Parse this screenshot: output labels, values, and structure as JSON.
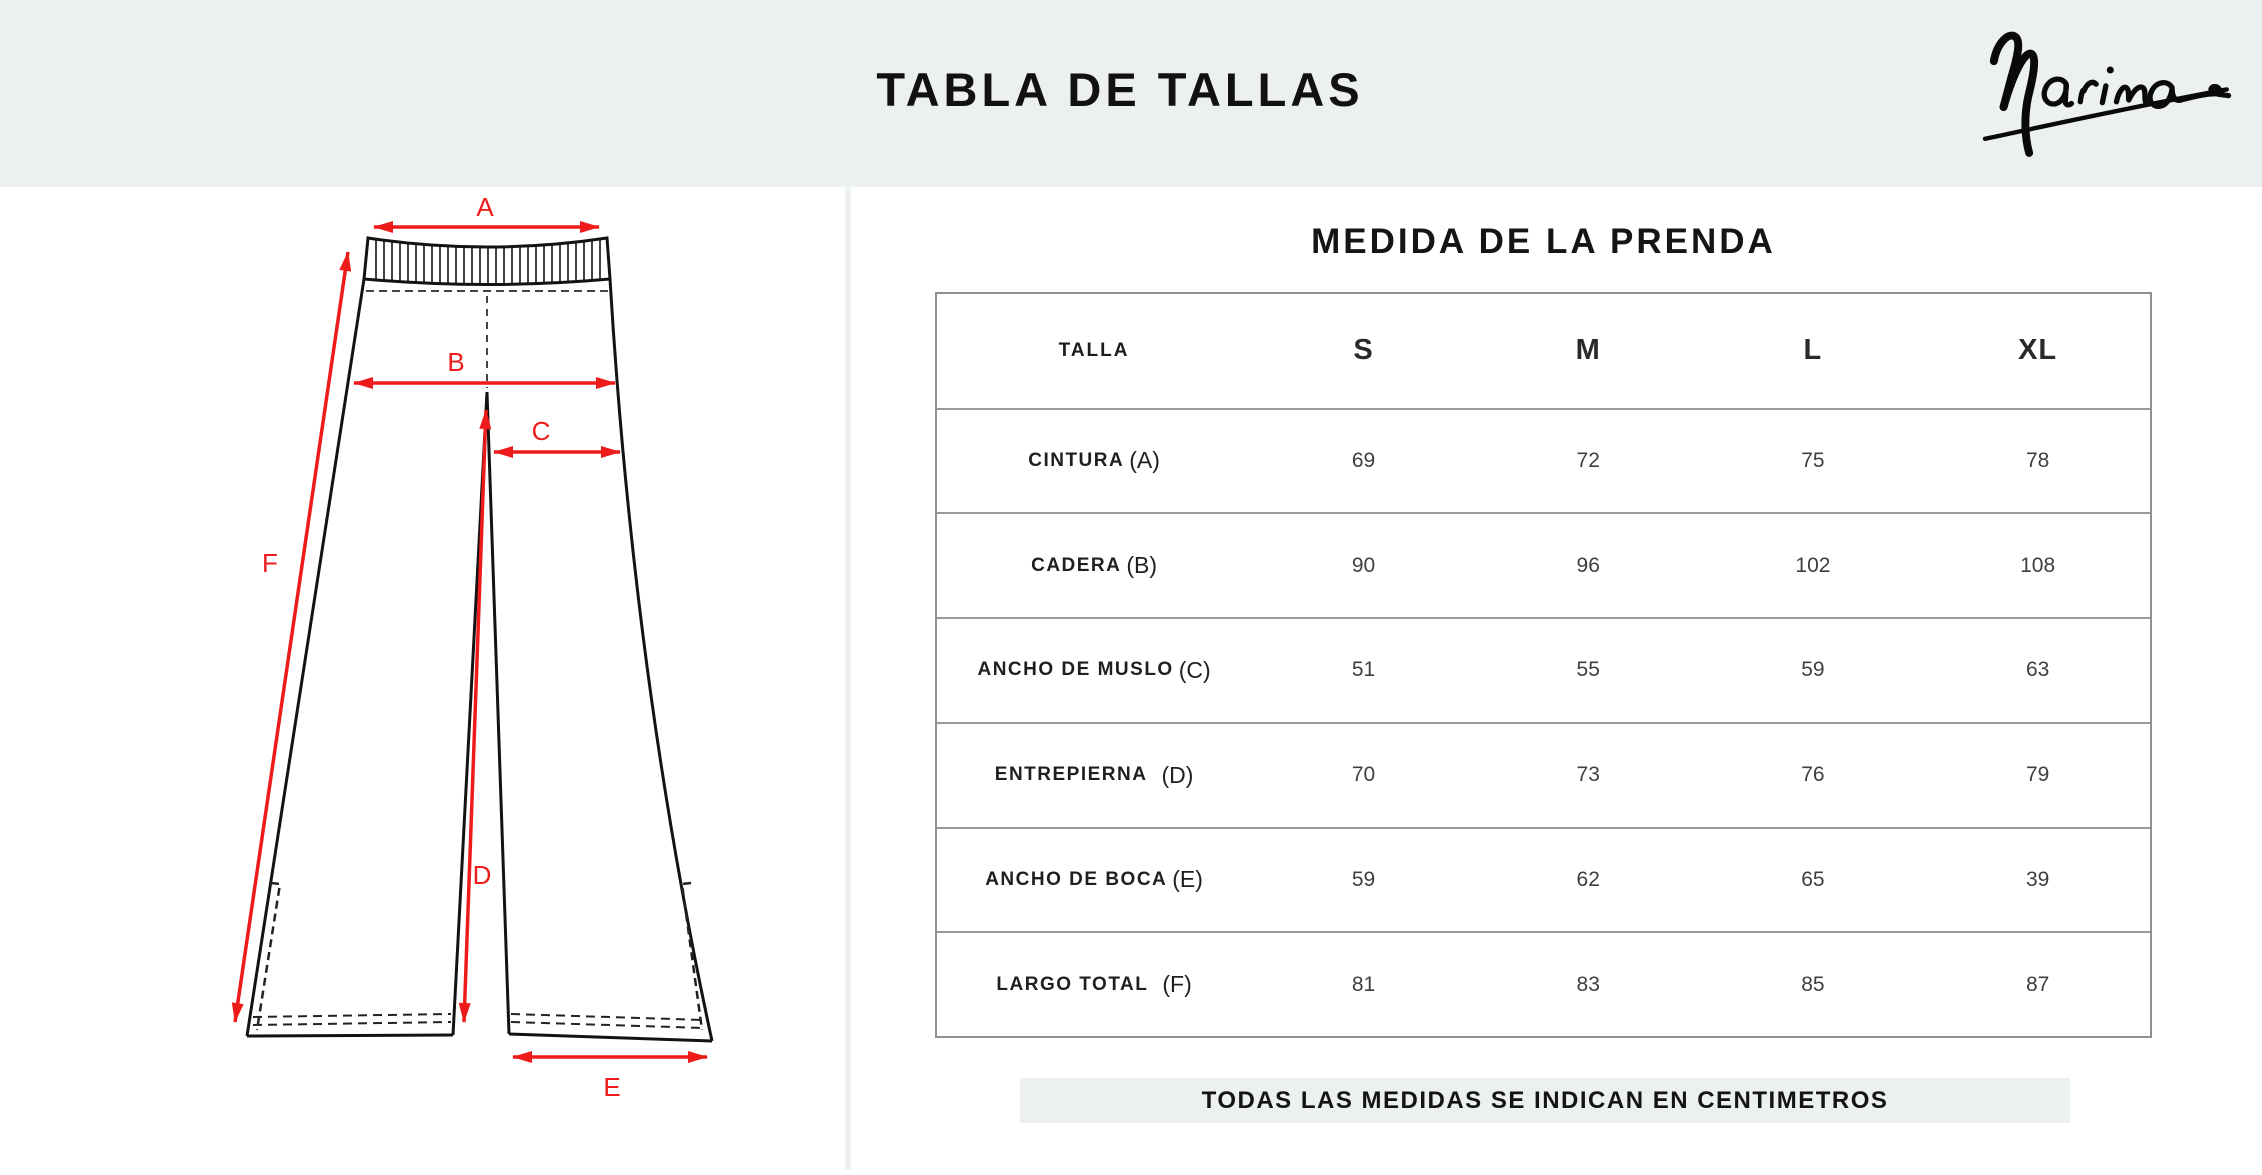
{
  "header": {
    "title": "TABLA DE TALLAS"
  },
  "brand": {
    "name": "Marina"
  },
  "diagram": {
    "subject_labels": {
      "a": "A",
      "b": "B",
      "c": "C",
      "d": "D",
      "e": "E",
      "f": "F"
    }
  },
  "table": {
    "title": "MEDIDA DE LA PRENDA",
    "size_header": "TALLA",
    "sizes": [
      "S",
      "M",
      "L",
      "XL"
    ],
    "rows": [
      {
        "label": "CINTURA",
        "marker": "(A)",
        "values": [
          "69",
          "72",
          "75",
          "78"
        ]
      },
      {
        "label": "CADERA",
        "marker": "(B)",
        "values": [
          "90",
          "96",
          "102",
          "108"
        ]
      },
      {
        "label": "ANCHO DE MUSLO",
        "marker": "(C)",
        "values": [
          "51",
          "55",
          "59",
          "63"
        ]
      },
      {
        "label": "ENTREPIERNA",
        "marker": "(D)",
        "values": [
          "70",
          "73",
          "76",
          "79"
        ]
      },
      {
        "label": "ANCHO DE BOCA",
        "marker": "(E)",
        "values": [
          "59",
          "62",
          "65",
          "39"
        ]
      },
      {
        "label": "LARGO TOTAL",
        "marker": "(F)",
        "values": [
          "81",
          "83",
          "85",
          "87"
        ]
      }
    ]
  },
  "footer": {
    "note": "TODAS LAS MEDIDAS SE INDICAN EN CENTIMETROS"
  },
  "colors": {
    "accent_red": "#ee1b1b",
    "panel_gray": "#edf0f1",
    "table_border": "#8f8f8f",
    "line_black": "#131313"
  }
}
